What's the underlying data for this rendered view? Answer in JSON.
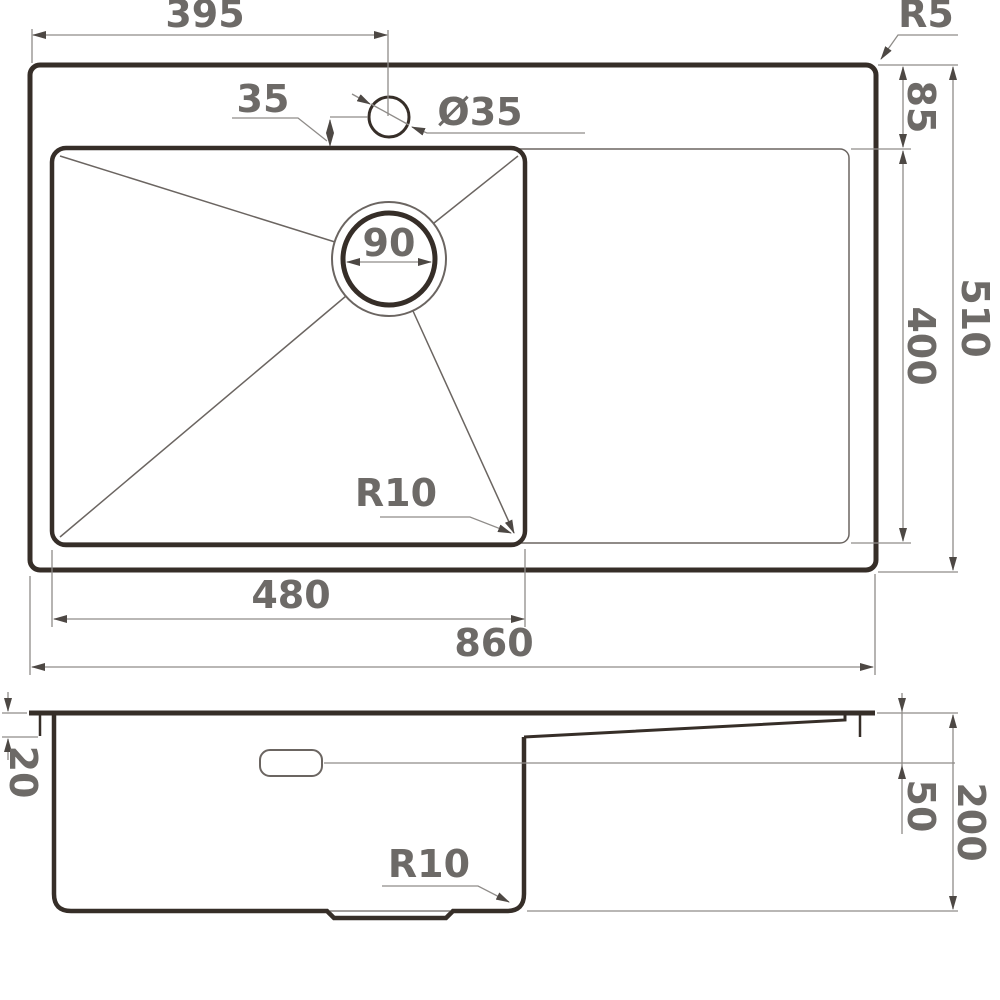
{
  "drawing": {
    "type": "technical-dimension-drawing",
    "views": [
      "top-view",
      "section-view"
    ]
  },
  "labels": {
    "tap_center_width": "395",
    "outer_corner_radius": "R5",
    "tap_offset": "35",
    "tap_hole_diameter": "Ø35",
    "rim_to_bowl": "85",
    "drain_diameter": "90",
    "bowl_depth_front": "400",
    "total_depth_top": "510",
    "bowl_corner_radius": "R10",
    "bowl_width": "480",
    "total_width": "860",
    "rim_height": "20",
    "board_depth": "50",
    "total_height": "200",
    "bottom_corner_radius": "R10"
  },
  "colors": {
    "outline": "#362e28",
    "dimension_lines": "#8f8c89",
    "dimension_text": "#6d6a67",
    "background": "#ffffff"
  }
}
